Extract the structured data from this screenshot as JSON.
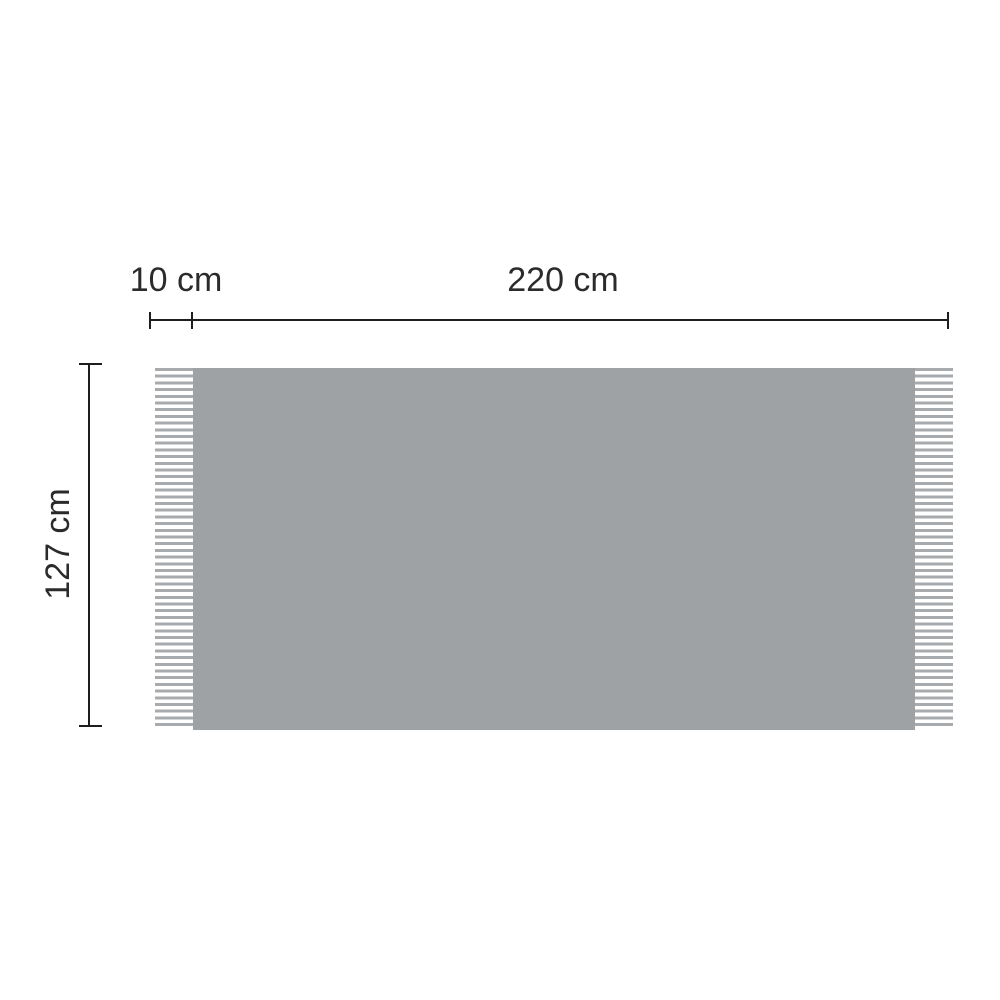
{
  "diagram": {
    "type": "product-dimension-diagram",
    "labels": {
      "fringe_width": "10 cm",
      "body_width": "220 cm",
      "height": "127 cm"
    },
    "colors": {
      "background": "#ffffff",
      "blanket_fill": "#9ea2a5",
      "fringe_stripe": "#a8abae",
      "dimension_line": "#1e1e1e",
      "label_text": "#2b2b2b"
    }
  }
}
